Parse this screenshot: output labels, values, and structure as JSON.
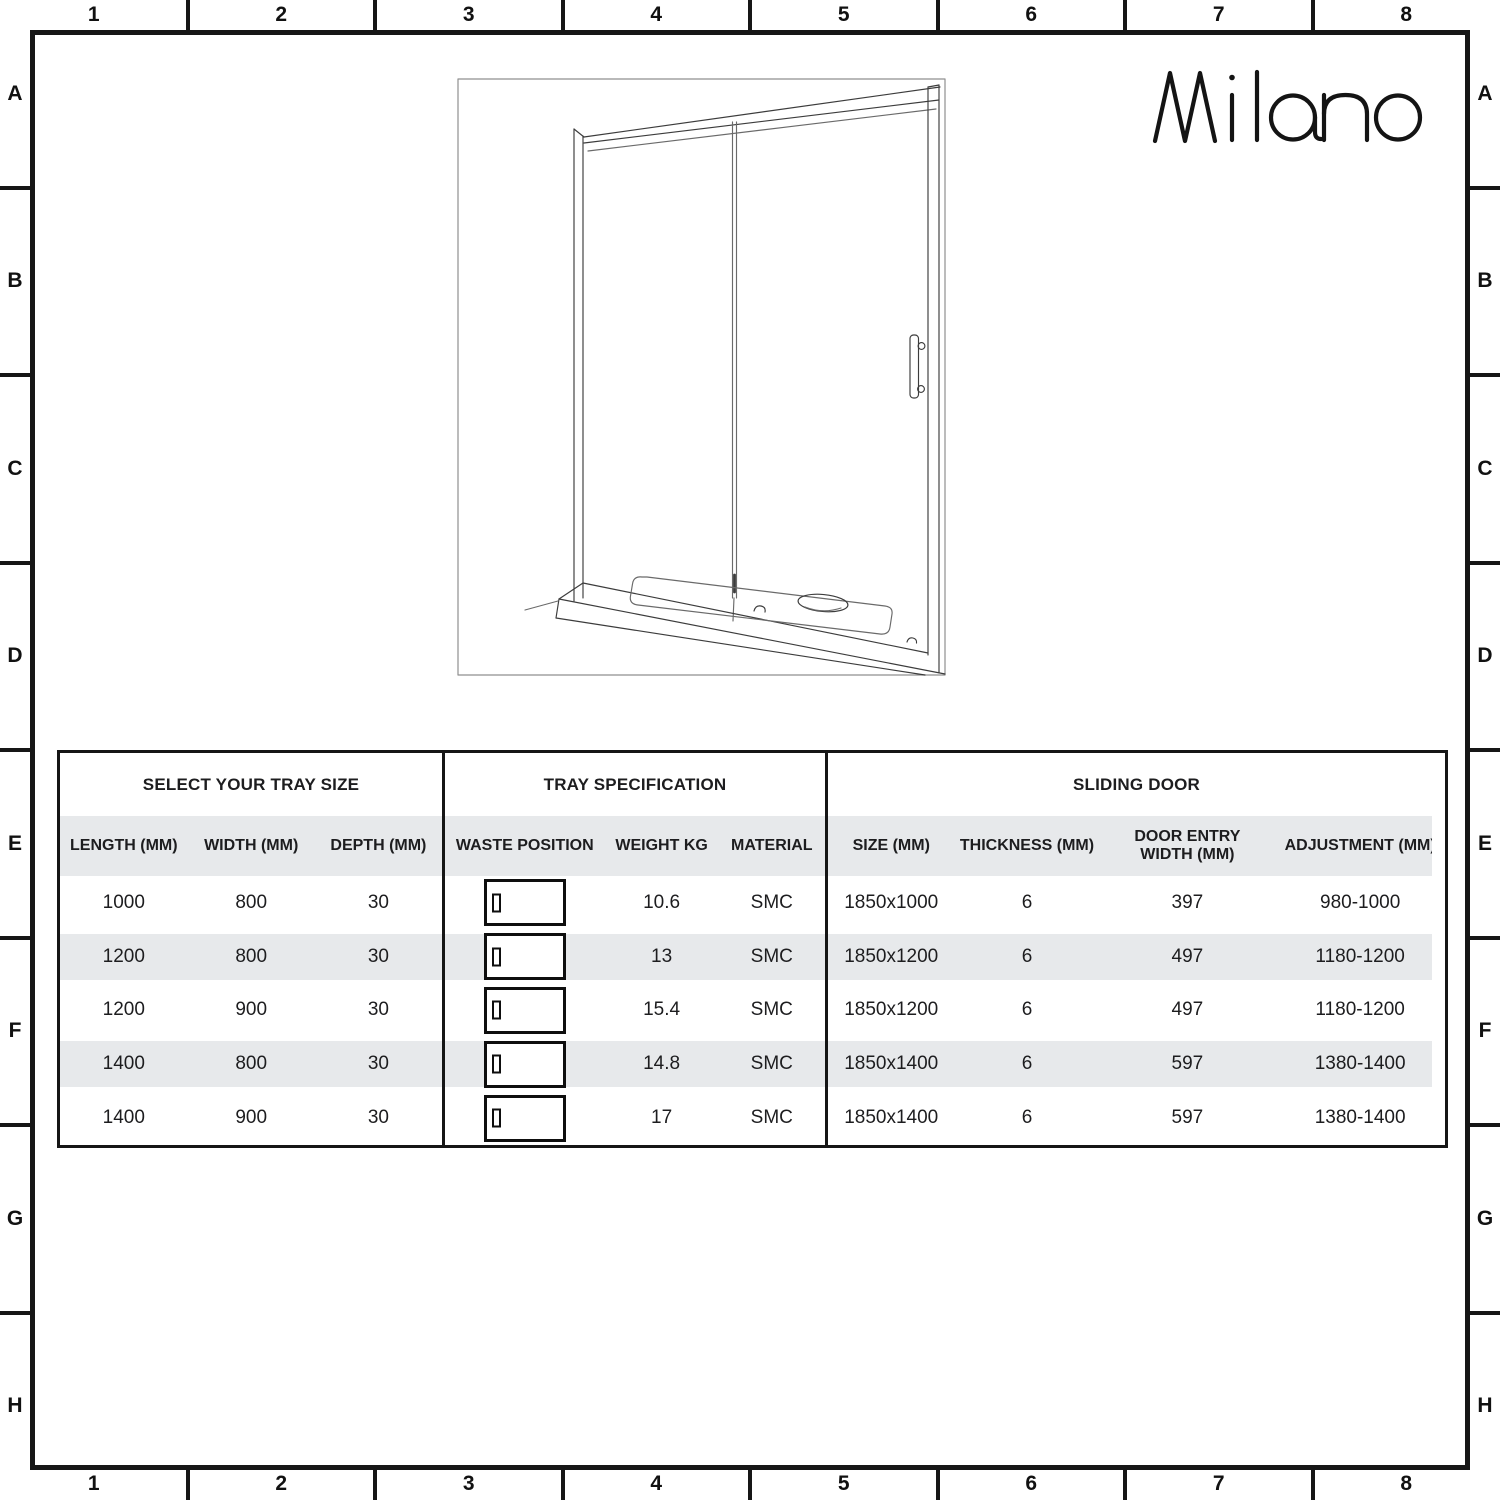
{
  "brand": {
    "logo_text": "Milano"
  },
  "grid": {
    "column_labels": [
      "1",
      "2",
      "3",
      "4",
      "5",
      "6",
      "7",
      "8"
    ],
    "row_labels": [
      "A",
      "B",
      "C",
      "D",
      "E",
      "F",
      "G",
      "H"
    ]
  },
  "icons": {
    "waste_position": "tray-waste-position-icon"
  },
  "colors": {
    "stripe": "#e7e9eb",
    "line": "#161616",
    "text": "#1d1d1f"
  },
  "table": {
    "sections": [
      {
        "title": "SELECT YOUR TRAY SIZE",
        "columns": [
          "LENGTH (MM)",
          "WIDTH (MM)",
          "DEPTH (MM)"
        ],
        "rows": [
          [
            "1000",
            "800",
            "30"
          ],
          [
            "1200",
            "800",
            "30"
          ],
          [
            "1200",
            "900",
            "30"
          ],
          [
            "1400",
            "800",
            "30"
          ],
          [
            "1400",
            "900",
            "30"
          ]
        ]
      },
      {
        "title": "TRAY SPECIFICATION",
        "columns": [
          "WASTE POSITION",
          "WEIGHT KG",
          "MATERIAL"
        ],
        "rows": [
          [
            "icon:waste-position",
            "10.6",
            "SMC"
          ],
          [
            "icon:waste-position",
            "13",
            "SMC"
          ],
          [
            "icon:waste-position",
            "15.4",
            "SMC"
          ],
          [
            "icon:waste-position",
            "14.8",
            "SMC"
          ],
          [
            "icon:waste-position",
            "17",
            "SMC"
          ]
        ]
      },
      {
        "title": "SLIDING DOOR",
        "columns": [
          "SIZE (MM)",
          "THICKNESS (MM)",
          "DOOR ENTRY WIDTH (MM)",
          "ADJUSTMENT (MM)"
        ],
        "rows": [
          [
            "1850x1000",
            "6",
            "397",
            "980-1000"
          ],
          [
            "1850x1200",
            "6",
            "497",
            "1180-1200"
          ],
          [
            "1850x1200",
            "6",
            "497",
            "1180-1200"
          ],
          [
            "1850x1400",
            "6",
            "597",
            "1380-1400"
          ],
          [
            "1850x1400",
            "6",
            "597",
            "1380-1400"
          ]
        ]
      }
    ]
  }
}
